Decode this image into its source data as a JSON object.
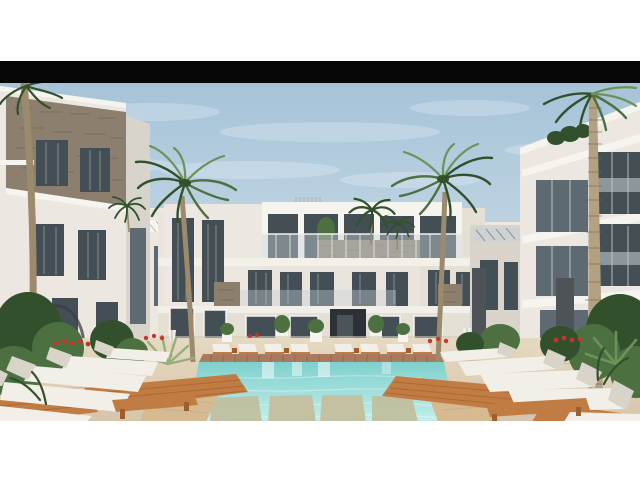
{
  "page": {
    "background": "#ffffff"
  },
  "artwork": {
    "type": "architectural-rendering",
    "subject": "Modern white resort apartment complex courtyard with swimming pool, palm trees and sun loungers",
    "letterbox_bar": {
      "color": "#070707",
      "y": 61,
      "height": 22
    },
    "photo_area": {
      "x": 0,
      "y": 83,
      "width": 640,
      "height": 338
    }
  },
  "palette": {
    "sky_top": "#a6c3d8",
    "sky_horizon": "#dde8ef",
    "haze": "#e4edf2",
    "cloud": "#ffffff",
    "bar": "#070707",
    "wall": "#ece8e1",
    "wall_bright": "#f6f4ef",
    "wall_shade": "#d8d4cb",
    "wall_warm": "#e5e0d6",
    "stone": "#8d7f6e",
    "stone_line": "#675b4c",
    "stone_dark": "#4e5357",
    "glass": "#434e55",
    "glass_light": "#5d6a72",
    "curtain": "#c9cccb",
    "rail_glass": "#c7d3d6",
    "water_deep": "#7fd0cd",
    "water_shallow": "#c3efea",
    "coping": "#a87b5e",
    "coping_line": "#8a6046",
    "deck": "#d6c5aa",
    "deck_light": "#e6d9c1",
    "deck_line": "#bfab8d",
    "wood": "#c07c43",
    "wood_dark": "#9d5f2c",
    "wood_light": "#d5ba92",
    "cushion": "#f2efe8",
    "cushion_shade": "#d9d4ca",
    "green_dark": "#32502c",
    "green": "#4c7040",
    "green_light": "#6d9158",
    "agave": "#96ae7a",
    "trunk": "#9b8a6b",
    "trunk_ring": "#7c6b50",
    "trunk_light": "#b3a184",
    "flower": "#c4372f"
  },
  "scene": {
    "sky": "clear blue sky with wispy clouds",
    "buildings": {
      "left": "two-storey block with stone-clad upper facade and dark framed windows",
      "center": "three-storey symmetrical apartment building with roof terrace, glass balustrades, stone accent bands and central entrance",
      "right": "three-storey block with recessed dark-glass balconies and rooftop plants",
      "background": "low white annex buildings with striped pergola awnings"
    },
    "vegetation": {
      "palm_trees": [
        "curved palm left of center",
        "curved palm right of center",
        "ringed-trunk palm far left",
        "tall ringed-trunk palm far right",
        "small distant palms"
      ],
      "ground_planting": "tropical shrubs, agave and banana plants with red flower accents"
    },
    "pool": {
      "description": "turquoise swimming pool with terracotta tile coping and submerged timber sun-shelf platforms",
      "platform_count": 4
    },
    "furniture": {
      "foreground_loungers_left": 5,
      "foreground_loungers_right": 5,
      "far_side_loungers": 8,
      "benches": 2,
      "folded_parasols": 2,
      "description": "white cushioned sun loungers on slatted orange-timber platforms angled toward the pool"
    }
  }
}
